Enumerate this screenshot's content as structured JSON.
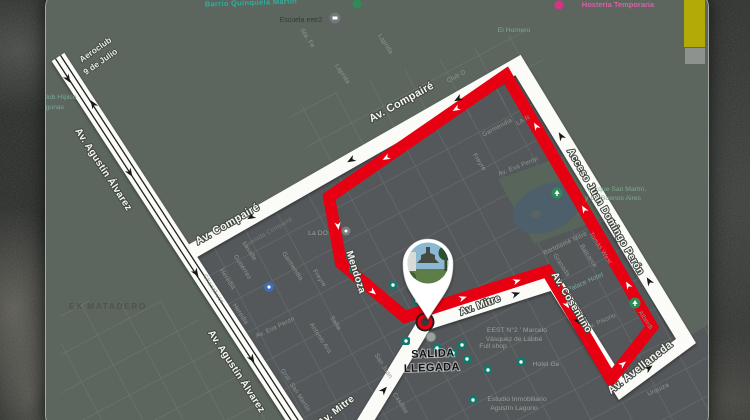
{
  "colors": {
    "route_white": "#fbfbf8",
    "route_red": "#e60012",
    "map_green": "#5c665e",
    "map_urban": "#54585b",
    "pond_blue": "#4d5f6a",
    "sticker_yellow": "#b3aa08",
    "sticker_gray": "#8d928e",
    "start_ring_red": "#e60012"
  },
  "start": {
    "line1": "SALIDA",
    "line2": "LLEGADA"
  },
  "avenues": {
    "compaire_upper": "Av. Compairé",
    "compaire_lower": "Av. Compairé",
    "alvarez_upper": "Av. Agustín Álvarez",
    "alvarez_lower": "Av. Agustín Álvarez",
    "acceso": "Acceso Juan Domingo Perón",
    "mitre_center": "Av. Mitre",
    "mitre_bottom": "Av. Mitre",
    "avellaneda": "Av. Avellaneda",
    "cosentino": "Av. Cosentino",
    "mendoza": "Mendoza"
  },
  "areas": {
    "ex_matadero": "EX MATADERO",
    "aeroclub_line1": "Aeroclub",
    "aeroclub_line2": "9 de Julio",
    "parque_line1": "Parque San Martín,",
    "parque_line2": "y De Buenos Aires",
    "barrio_top": "Barrio Quinquela Martín",
    "hosteria_top": "Hostería Temporaria"
  },
  "streets": {
    "laprida_1": "Laprida",
    "laprida_2": "Laprida",
    "sta_fe": "Sta. Fe",
    "lavalle": "Lavalle",
    "gutierrez": "Gutiérrez",
    "heredia_1": "Heredia",
    "heredia_2": "Heredia",
    "chacabuco": "Chacabuco",
    "salta": "Salta",
    "antonio_ara": "Antonio Ara",
    "gral_san_martin": "Gral. San Martín",
    "san_juan": "San Juan",
    "casillas": "Casillas",
    "freyre_1": "Freyre",
    "freyre_2": "Freyre",
    "garmendia_1": "Garmendia",
    "garmendia_2": "Garmendia",
    "la_fragment": "LA R",
    "eva_peron_1": "Av. Eva Perón",
    "eva_peron_2": "Av. Eva Perón",
    "tomas_west": "Tomás West",
    "balcarce": "Balcarce",
    "granada": "Granada",
    "bartolome_mitre": "Bartolomé Mitre",
    "av_pisorio": "Av. Pisorio",
    "urquiza": "Urquiza",
    "alberdi": "Alberdi",
    "avenida_compaire": "Avenida Compairé",
    "club_d": "Club D"
  },
  "pois": {
    "escuela": "Escuela eetr2",
    "el_hornero": "El Hornero",
    "club_hipico_line1": "Club Hípico",
    "club_hipico_line2": "Lagunas",
    "la_do": "La DO",
    "eest_line1": "EEST N°2 ' Marcelo",
    "eest_line2": "Vásquez de Labbé",
    "full_shop": "Full shop",
    "hotel_ge": "Hotel Ge",
    "palace_hotel": "Palace Hotel",
    "estudio_line1": "Estudio Inmobiliario",
    "estudio_line2": "Agustín Lagorio"
  }
}
